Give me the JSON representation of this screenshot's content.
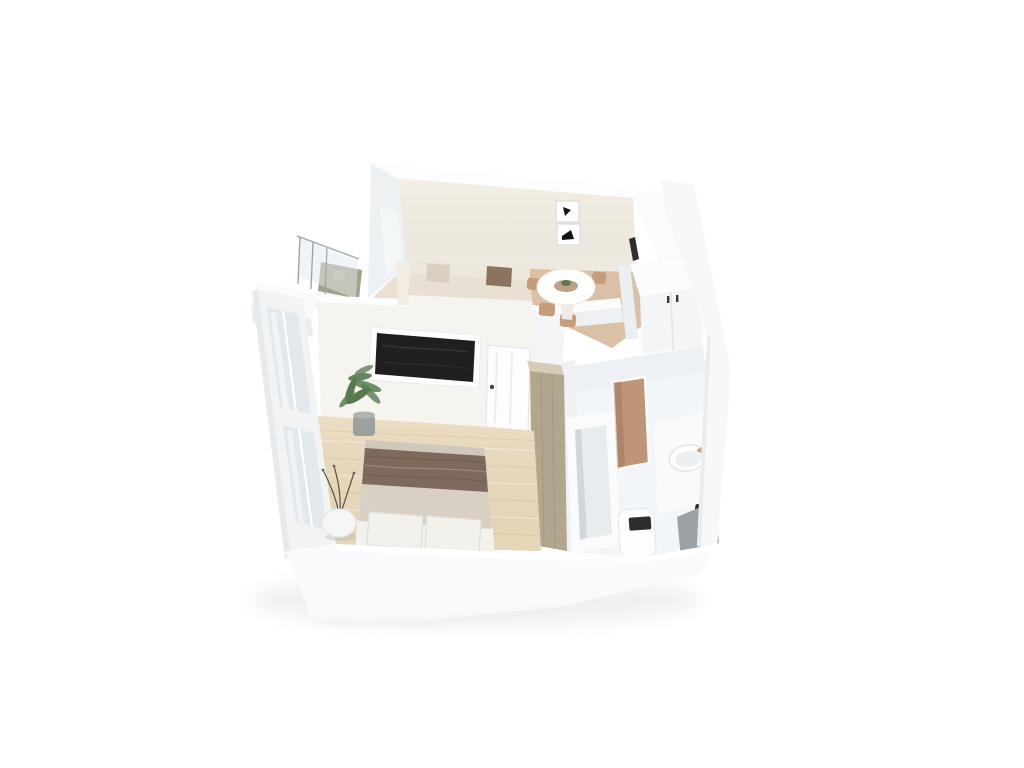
{
  "scene": {
    "kind": "3d-isometric-floorplan-render",
    "description": "Photorealistic cutaway 3D rendering of a one-bedroom apartment viewed from above on a plain white background",
    "rooms": [
      {
        "id": "living-room",
        "label": "living-dining room"
      },
      {
        "id": "bedroom",
        "label": "bedroom"
      },
      {
        "id": "bathroom",
        "label": "bathroom"
      },
      {
        "id": "balcony",
        "label": "balcony"
      },
      {
        "id": "entry-closet",
        "label": "entry closet nook"
      }
    ],
    "furniture": [
      "sofa",
      "throw-pillows",
      "round-dining-table",
      "dining-chairs",
      "framed-wall-art",
      "kitchen-counter",
      "built-in-closet",
      "double-bed",
      "bed-blanket",
      "bed-pillows",
      "wall-tv",
      "potted-plant",
      "decor-vase-with-branches",
      "tall-wardrobe",
      "interior-door",
      "bathtub",
      "tiled-shower-niche",
      "washbasin",
      "toilet",
      "vanity-cabinet",
      "balcony-glass-railing"
    ]
  },
  "colors": {
    "background": "#ffffff",
    "wall_bright": "#fbfcfd",
    "wall_light": "#f4f6f8",
    "wall_shade": "#e9ecef",
    "wall_cream": "#f2eee5",
    "living_floor": "#eae1d3",
    "dining_floor": "#d8c1a6",
    "wood_floor": "#e9d9bc",
    "balcony_floor": "#a4a18a",
    "bath_floor": "#f3f6f8",
    "tile_accent": "#bf9478",
    "wardrobe_wood": "#b2a68f",
    "blanket_brown": "#7e6a5c",
    "duvet_cream": "#d8d0c4",
    "pillow_white": "#f3f1ec",
    "mattress_trim": "#cfc8bb",
    "sofa_cream": "#e7e0d3",
    "sofa_back": "#eee8dc",
    "cushion_beige": "#d9d0c0",
    "cushion_brown": "#8a7460",
    "chair_tan": "#c69d7b",
    "tv_black": "#211f1d",
    "plant_green": "#577a4f",
    "pot_gray": "#9ba19d",
    "vanity_gray": "#9aa1a7",
    "fixture_dark": "#2f2e2c",
    "glass_tint": "#e2e9ee",
    "shadow": "#c6ccd1"
  }
}
